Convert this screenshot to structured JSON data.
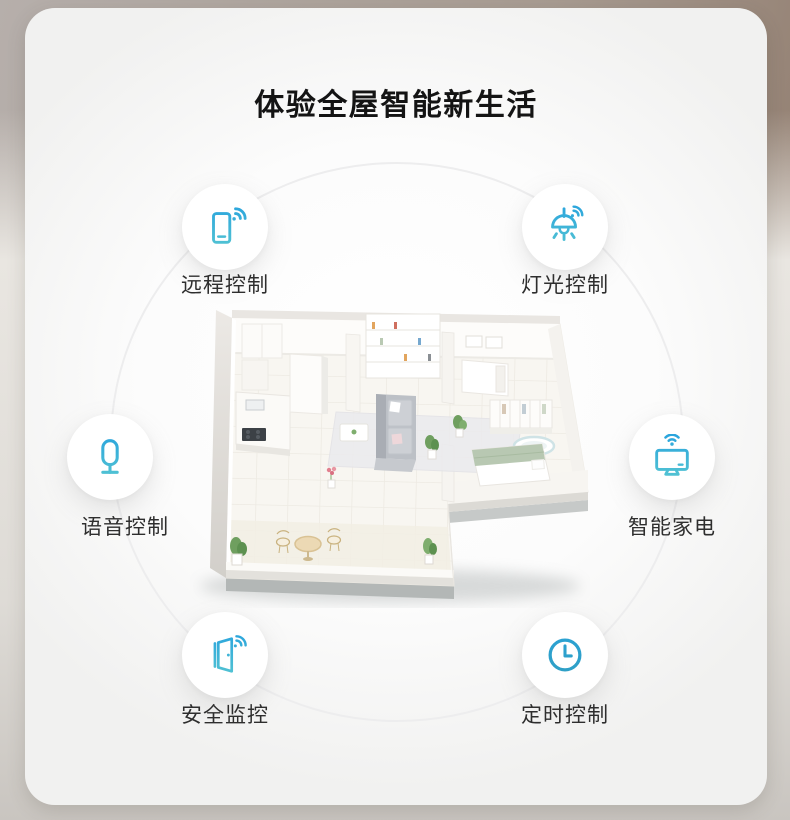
{
  "page": {
    "title": "体验全屋智能新生活"
  },
  "features": [
    {
      "id": "remote",
      "label": "远程控制",
      "icon": "phone-wifi-icon"
    },
    {
      "id": "light",
      "label": "灯光控制",
      "icon": "pendant-lamp-wifi-icon"
    },
    {
      "id": "voice",
      "label": "语音控制",
      "icon": "microphone-icon"
    },
    {
      "id": "appliance",
      "label": "智能家电",
      "icon": "tv-wifi-icon"
    },
    {
      "id": "security",
      "label": "安全监控",
      "icon": "door-wifi-icon"
    },
    {
      "id": "timer",
      "label": "定时控制",
      "icon": "clock-icon"
    }
  ],
  "colors": {
    "accent_blue": "#2aa4dd",
    "accent_teal": "#55c5d2",
    "title_text": "#141414",
    "label_text": "#2e2e2e",
    "card_background": "#ffffff",
    "outer_background_left": "#b6afab",
    "outer_background_right": "#8a7363"
  },
  "illustration": {
    "name": "isometric-apartment-floor-plan",
    "elements": [
      "living-room-sofa",
      "rug",
      "coffee-table",
      "bookshelf",
      "kitchen-counter",
      "cooktop",
      "bedroom-bed",
      "wardrobe",
      "bathtub",
      "balcony-table",
      "balcony-chairs",
      "plants"
    ]
  }
}
